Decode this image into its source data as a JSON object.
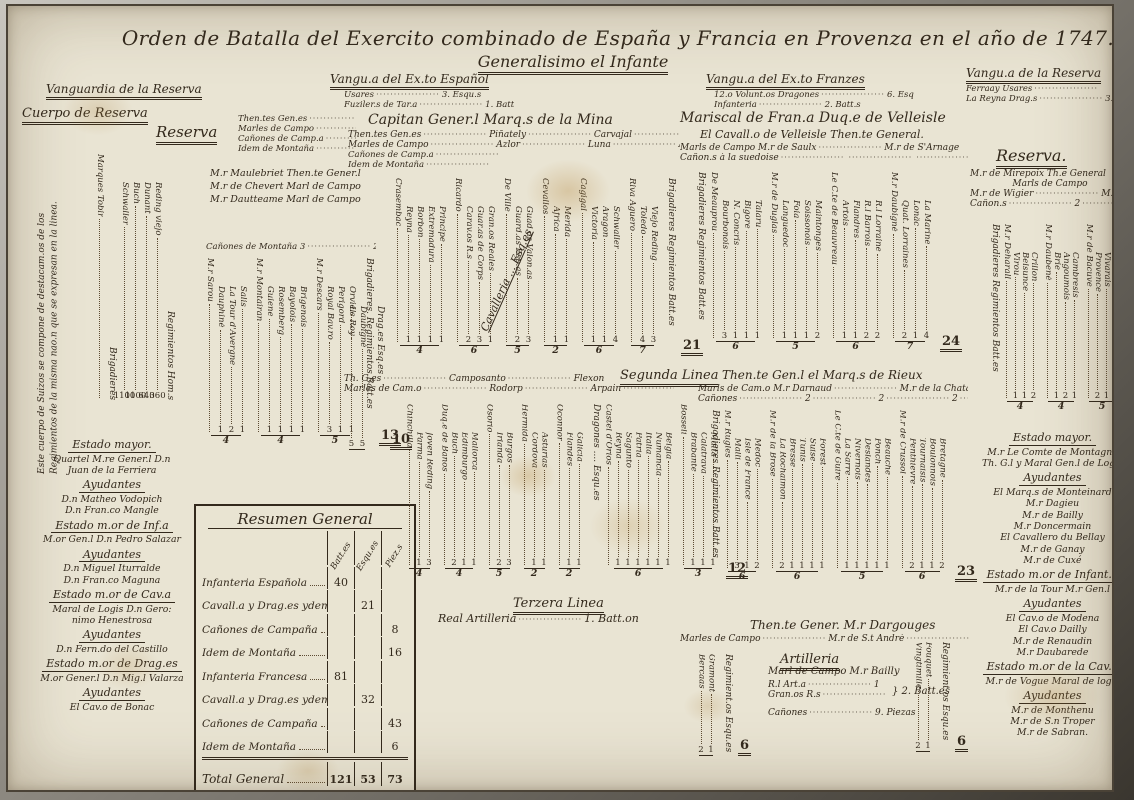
{
  "header": {
    "title": "Orden de Batalla del Exercito combinado de España y Francia en Provenza en el año de 1747.",
    "subtitle": "Generalisimo el Infante"
  },
  "vanguards": {
    "v1": {
      "h": "Vanguardia de la Reserva"
    },
    "v2": {
      "h": "Vangu.a del Ex.to Español",
      "rows": [
        [
          "Usares",
          "3. Esqu.s"
        ],
        [
          "Fuziler.s de Tar.a",
          "1. Batt.on"
        ]
      ]
    },
    "v3": {
      "h": "Vangu.a del Ex.to Franzes",
      "rows": [
        [
          "12.o Volunt.os Dragones",
          "6. Esqu.s"
        ],
        [
          "Infanteria",
          "2. Batt.s"
        ]
      ]
    },
    "v4": {
      "h": "Vangu.a de la Reserva",
      "rows": [
        [
          "Ferraay Usares",
          ""
        ],
        [
          "La Reyna Drag.s",
          "3.4 Es."
        ]
      ]
    }
  },
  "left": {
    "cuerpo_heading": "Cuerpo de Reserva",
    "note_rot": "Este cuerpo de Suizos se compone de destacam.os de los Regimientos de la misma nao.n que se expresan en la linea.",
    "reserva_heading": "Reserva",
    "staff_rows": [
      [
        "Then.tes Gen.es",
        ""
      ],
      [
        "Marles de Campo",
        ""
      ],
      [
        "Cañones de Camp.a",
        ""
      ],
      [
        "Idem de Montaña",
        ""
      ]
    ],
    "commanders": [
      "M.r Maulebriet Then.te Gener.l",
      "M.r de Chevert Marl de Campo",
      "M.r Dautteame Marl de Campo"
    ],
    "canones_row": [
      "Cañones de Montaña 3",
      "2",
      "2",
      "2"
    ],
    "swiss": {
      "brigadier": "Marques Tobir",
      "axis1": "Brigadieres",
      "axis2": "Regimientos Hom.s",
      "units": [
        [
          "Schwaller",
          "1100"
        ],
        [
          "Buch",
          "1100"
        ],
        [
          "Dunant",
          "640"
        ],
        [
          "Reding viejo",
          "360"
        ]
      ]
    }
  },
  "wings": {
    "left_inf": {
      "axis": "Brigadieres. Regimientos Batt.es",
      "grand": "13",
      "groups": [
        {
          "b": "M.r Sarou",
          "u": [
            [
              "Dauphiné",
              "1"
            ],
            [
              "La Tour d'Avergne",
              "2"
            ],
            [
              "Salis",
              "1"
            ]
          ],
          "t": "4"
        },
        {
          "b": "M.r Montairan",
          "u": [
            [
              "Guiene",
              "1"
            ],
            [
              "Rosemberg",
              "1"
            ],
            [
              "Bayolois",
              "1"
            ],
            [
              "Brigenois",
              "1"
            ]
          ],
          "t": "4"
        },
        {
          "b": "M.r Descars",
          "u": [
            [
              "Royal Bav.ro",
              "3"
            ],
            [
              "Perigord",
              "1"
            ],
            [
              "Orviel",
              "1"
            ]
          ],
          "t": "5"
        }
      ]
    },
    "left_drag": {
      "axis": "Drag.es Esq.es",
      "grand": "10",
      "groups": [
        {
          "b": "",
          "u": [
            [
              "Le Roy",
              "5"
            ],
            [
              "Daubigné",
              "5"
            ]
          ],
          "t": ""
        }
      ]
    },
    "sp1": {
      "axis": "Brigadieres Regimientos Batt.es",
      "grand": "21",
      "groups": [
        {
          "b": "Crasembac",
          "u": [
            [
              "Reyna",
              "1"
            ],
            [
              "Borbon",
              "1"
            ],
            [
              "Extremadura",
              "1"
            ],
            [
              "Principe",
              "1"
            ]
          ],
          "t": "4"
        },
        {
          "b": "Ricardo",
          "u": [
            [
              "Carav.os R.s",
              "2"
            ],
            [
              "Guar.as de Corps",
              "3"
            ],
            [
              "Gran.os Reales",
              "1"
            ]
          ],
          "t": "6"
        },
        {
          "b": "De Ville",
          "u": [
            [
              "Guard.as Esp.as",
              "2"
            ],
            [
              "Guad.as Valon.as",
              "3"
            ]
          ],
          "t": "5"
        },
        {
          "b": "Cevallos",
          "u": [
            [
              "Africa",
              "1"
            ],
            [
              "Merida",
              "1"
            ]
          ],
          "t": "2"
        },
        {
          "b": "Cagigal",
          "u": [
            [
              "Victoria",
              "1"
            ],
            [
              "Aragon",
              "1"
            ],
            [
              "Schwaller",
              "4"
            ]
          ],
          "t": "6"
        },
        {
          "b": "Riva Aguero",
          "u": [
            [
              "Toledo",
              "4"
            ],
            [
              "Viejo Reding",
              "3"
            ]
          ],
          "t": "7"
        }
      ]
    },
    "sp2i": {
      "groups": [
        {
          "b": "Chinchilla",
          "u": [
            [
              "Parma",
              "1"
            ],
            [
              "Joven Reding",
              "3"
            ]
          ],
          "t": "4"
        },
        {
          "b": "Duq.e de Baños",
          "u": [
            [
              "Buch",
              "2"
            ],
            [
              "Edimburgo",
              "1"
            ],
            [
              "Mallorca",
              "1"
            ]
          ],
          "t": "4"
        },
        {
          "b": "Osorio",
          "u": [
            [
              "Irlanda",
              "2"
            ],
            [
              "Burgos",
              "3"
            ]
          ],
          "t": "5"
        },
        {
          "b": "Hermida",
          "u": [
            [
              "Cordova",
              "1"
            ],
            [
              "Asturias",
              "1"
            ]
          ],
          "t": "2"
        },
        {
          "b": "Oconnor",
          "u": [
            [
              "Flandes",
              "1"
            ],
            [
              "Galicia",
              "1"
            ]
          ],
          "t": "2"
        }
      ]
    },
    "sp2d": {
      "axis": "Dragones .... Esqu.es",
      "grand": "12",
      "groups": [
        {
          "b": "Castel d'Orios",
          "u": [
            [
              "Reyna",
              "1"
            ],
            [
              "Sagunto",
              "1"
            ],
            [
              "Patria",
              "1"
            ],
            [
              "Italia",
              "1"
            ],
            [
              "Numancia",
              "1"
            ],
            [
              "Belgia",
              "1"
            ]
          ],
          "t": "6"
        },
        {
          "b": "Bosseli",
          "u": [
            [
              "Brabante",
              "1"
            ],
            [
              "Calatrava",
              "1"
            ],
            [
              "Malta",
              "1"
            ]
          ],
          "t": "3"
        }
      ]
    },
    "fr1": {
      "axis": "Brigadieres Regimientos Batt.es",
      "grand": "24",
      "groups": [
        {
          "b": "De Meauprou",
          "u": [
            [
              "Bourbonois",
              "3"
            ],
            [
              "N. Concris",
              "1"
            ],
            [
              "Bigore",
              "1"
            ],
            [
              "Talaru",
              "1"
            ]
          ],
          "t": "6"
        },
        {
          "b": "M.r de Duglas",
          "u": [
            [
              "Languedoc",
              "1"
            ],
            [
              "Foia",
              "1"
            ],
            [
              "Soissonois",
              "1"
            ],
            [
              "Maintonges",
              "2"
            ]
          ],
          "t": "5"
        },
        {
          "b": "Le C.te de Beauvreau",
          "u": [
            [
              "Artois",
              "1"
            ],
            [
              "Flandres",
              "1"
            ],
            [
              "R.l Barrois",
              "2"
            ],
            [
              "R.l Lorraine",
              "2"
            ]
          ],
          "t": "6"
        },
        {
          "b": "M.r Daubigné",
          "u": [
            [
              "Quat. Lorraines",
              "2"
            ],
            [
              "Lonäc",
              "1"
            ],
            [
              "La Marine",
              "4"
            ]
          ],
          "t": "7"
        }
      ]
    },
    "fr2": {
      "axis": "Brigadieres Regimientos Batt.es",
      "grand": "23",
      "groups": [
        {
          "b": "M.r Rugles",
          "u": [
            [
              "Malli",
              "3"
            ],
            [
              "Isle de France",
              "1"
            ],
            [
              "Medoc",
              "2"
            ]
          ],
          "t": "6"
        },
        {
          "b": "M.r de la Brose",
          "u": [
            [
              "La Rochaimon",
              "2"
            ],
            [
              "Bresse",
              "1"
            ],
            [
              "Tunis",
              "1"
            ],
            [
              "Suise",
              "1"
            ],
            [
              "Forest",
              "1"
            ]
          ],
          "t": "6"
        },
        {
          "b": "Le C.te de Guire",
          "u": [
            [
              "La Sarre",
              "1"
            ],
            [
              "Nivernois",
              "1"
            ],
            [
              "Deslandes",
              "1"
            ],
            [
              "Ponch",
              "1"
            ],
            [
              "Beauche",
              "1"
            ]
          ],
          "t": "5"
        },
        {
          "b": "M.r de Crussol",
          "u": [
            [
              "Penthievre",
              "2"
            ],
            [
              "Tournaisis",
              "1"
            ],
            [
              "Boulonnois",
              "1"
            ],
            [
              "Bretagne",
              "2"
            ]
          ],
          "t": "6"
        }
      ]
    },
    "right": {
      "axis": "Brigadieres Regimientos Batt.es",
      "grand": "15",
      "groups": [
        {
          "b": "M.r Deharall",
          "u": [
            [
              "Virou",
              "1"
            ],
            [
              "Belsunce",
              "1"
            ],
            [
              "Crillon",
              "2"
            ]
          ],
          "t": "4"
        },
        {
          "b": "M.r Daubené",
          "u": [
            [
              "Brie",
              "1"
            ],
            [
              "Angoumois",
              "2"
            ],
            [
              "Cambresis",
              "1"
            ]
          ],
          "t": "4"
        },
        {
          "b": "M.r de Bacuve",
          "u": [
            [
              "Provence",
              "2"
            ],
            [
              "Vivarais",
              "1"
            ],
            [
              "La Reyne",
              "2"
            ]
          ],
          "t": "5"
        }
      ]
    },
    "bl": {
      "axis": "Regimient.os Esqu.es",
      "grand": "6",
      "groups": [
        {
          "b": "",
          "u": [
            [
              "Bercaas",
              "2"
            ],
            [
              "Gramont",
              "1"
            ]
          ],
          "t": ""
        }
      ]
    },
    "br": {
      "axis": "Regimient.os Esqu.es",
      "grand": "6",
      "groups": [
        {
          "b": "",
          "u": [
            [
              "Vingtimille",
              "2"
            ],
            [
              "Fouquet",
              "1"
            ]
          ],
          "t": ""
        }
      ]
    }
  },
  "spanish": {
    "cap_heading": "Capitan Gener.l Marq.s de la Mina",
    "rows": [
      [
        "Then.tes Gen.es",
        "Piñately",
        "Carvajal",
        "Croios"
      ],
      [
        "Marles de Campo",
        "Azlor",
        "Luna",
        "Ahumada"
      ],
      [
        "Cañones de Camp.a",
        ""
      ],
      [
        "Idem de Montaña",
        ""
      ]
    ],
    "line1_label": "Cavalleria ... Esq.es",
    "segunda_heading": "Segunda Linea",
    "l2rows": [
      [
        "Th. G.es",
        "Camposanto",
        "Flexon"
      ],
      [
        "Marles de Cam.o",
        "Rodorp",
        "Arpain",
        "Regalado"
      ]
    ],
    "tercera_heading": "Terzera Linea",
    "artilleria_row": [
      "Real Artilleria",
      "1. Batt.on"
    ]
  },
  "french": {
    "h1": "Mariscal de Fran.a Duq.e de Velleisle",
    "h2": "El Cavall.o de Velleisle Then.te General.",
    "rows": [
      [
        "Marls de Campo M.r de Saulx",
        "M.r de S'Arnage"
      ],
      [
        "Cañon.s à la suedoise",
        "",
        "",
        ""
      ]
    ],
    "rieux_heading": "Then.te Gen.l el Marq.s de Rieux",
    "rieux_rows": [
      [
        "Marls de Cam.o M.r Darnaud",
        "M.r de la Chatardie"
      ],
      [
        "Cañones",
        "2",
        "2",
        "2",
        "2"
      ]
    ],
    "dargouges_heading": "Then.te Gener. M.r Dargouges",
    "dargouges_row": [
      "Marles de Campo",
      "M.r de S.t Andrè",
      "M.r de Cossè",
      "M.r Mauroy"
    ],
    "artilleria": {
      "heading": "Artilleria",
      "bailly": "Marl de Campo M.r Bailly",
      "rows": [
        [
          "R.l Art.a",
          "1"
        ],
        [
          "Gran.os R.s",
          "1"
        ]
      ],
      "brace": "2. Batt.es",
      "canones_row": [
        "Cañones",
        "9. Piezas"
      ]
    }
  },
  "reserva_right": {
    "heading": "Reserva.",
    "l1": "M.r de Mirepoix Th.e General",
    "l2": "Marls de Campo",
    "row3": [
      "M.r de Wigier",
      "M.r de Pulpu"
    ],
    "row4": [
      "Cañon.s",
      "2",
      "2",
      "2"
    ]
  },
  "resumen": {
    "title": "Resumen General",
    "cols": [
      "Batt.es",
      "Esqu.es",
      "Piez.s"
    ],
    "rows": [
      {
        "l": "Infanteria Española",
        "b": "40",
        "e": "",
        "p": ""
      },
      {
        "l": "Cavall.a y Drag.es ydem",
        "b": "",
        "e": "21",
        "p": ""
      },
      {
        "l": "Cañones de Campaña",
        "b": "",
        "e": "",
        "p": "8"
      },
      {
        "l": "Idem de Montaña",
        "b": "",
        "e": "",
        "p": "16"
      },
      {
        "l": "Infanteria Francesa",
        "b": "81",
        "e": "",
        "p": ""
      },
      {
        "l": "Cavall.a y Drag.es ydem",
        "b": "",
        "e": "32",
        "p": ""
      },
      {
        "l": "Cañones de Campaña",
        "b": "",
        "e": "",
        "p": "43"
      },
      {
        "l": "Idem de Montaña",
        "b": "",
        "e": "",
        "p": "6"
      }
    ],
    "total": {
      "l": "Total General",
      "b": "121",
      "e": "53",
      "p": "73"
    }
  },
  "estado_left": {
    "sections": [
      {
        "h": "Estado mayor.",
        "lines": [
          "Quartel M.re Gener.l D.n",
          "Juan de la Ferriera"
        ]
      },
      {
        "h": "Ayudantes",
        "lines": [
          "D.n Matheo Vodopich",
          "D.n Fran.co Mangle"
        ]
      },
      {
        "h": "Estado m.or de Inf.a",
        "lines": [
          "M.or Gen.l D.n Pedro Salazar"
        ]
      },
      {
        "h": "Ayudantes",
        "lines": [
          "D.n Miguel Iturralde",
          "D.n Fran.co Maguna"
        ]
      },
      {
        "h": "Estado m.or de Cav.a",
        "lines": [
          "Maral de Logis D.n Gero:",
          "nimo Henestrosa"
        ]
      },
      {
        "h": "Ayudantes",
        "lines": [
          "D.n Fern.do del Castillo"
        ]
      },
      {
        "h": "Estado m.or de Drag.es",
        "lines": [
          "M.or Gener.l D.n Mig.l Valarza"
        ]
      },
      {
        "h": "Ayudantes",
        "lines": [
          "El Cav.o de Bonac"
        ]
      }
    ]
  },
  "estado_right": {
    "sections": [
      {
        "h": "Estado mayor.",
        "lines": [
          "M.r Le Comte de Montagne",
          "Th. G.l y Maral Gen.l de Logis"
        ]
      },
      {
        "h": "Ayudantes",
        "lines": [
          "El Marq.s de Monteinard",
          "M.r Dagieu",
          "M.r de Bailly",
          "M.r Doncermain",
          "El Cavallero du Bellay",
          "M.r de Ganay",
          "M.r de Cuxé"
        ]
      },
      {
        "h": "Estado m.or de Infant.a",
        "lines": [
          "M.r de la Tour M.r Gen.l"
        ]
      },
      {
        "h": "Ayudantes",
        "lines": [
          "El Cav.o de Modena",
          "El Cav.o Dailly",
          "M.r de Renaudin",
          "M.r Daubarede"
        ]
      },
      {
        "h": "Estado m.or de la Cav.a",
        "lines": [
          "M.r de Vogue Maral de logis"
        ]
      },
      {
        "h": "Ayudantes",
        "lines": [
          "M.r de Monthenu",
          "M.r de S.n Troper",
          "M.r de Sabran."
        ]
      }
    ]
  }
}
